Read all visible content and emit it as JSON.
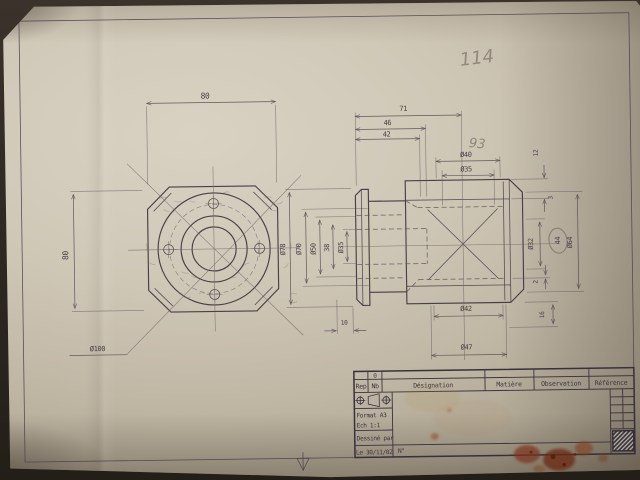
{
  "ann": {
    "page_number": "114",
    "note": "93"
  },
  "dims": {
    "front_width": "80",
    "front_height": "80",
    "front_flange": "Ø100",
    "len_71": "71",
    "len_46": "46",
    "len_42": "42",
    "dia_40": "Ø40",
    "dia_35_top": "Ø35",
    "dia_78": "Ø78",
    "dia_70": "Ø70",
    "dia_50": "Ø50",
    "len_38": "38",
    "dia_35_side": "Ø35",
    "len_12": "12",
    "cham_3": "3",
    "dia_32": "Ø32",
    "sq_44": "44",
    "dia_64": "Ø64",
    "len_2": "2",
    "len_16": "16",
    "len_10": "10",
    "dia_42": "Ø42",
    "dia_47": "Ø47"
  },
  "tb": {
    "rev": "0",
    "col_rep": "Rep",
    "col_nb": "Nb",
    "col_designation": "Désignation",
    "col_matiere": "Matière",
    "col_observation": "Observation",
    "col_reference": "Référence",
    "format": "Format A3",
    "scale": "Ech 1:1",
    "drawn_by": "Dessiné par",
    "date": "Le 30/11/02",
    "number": "N°"
  }
}
